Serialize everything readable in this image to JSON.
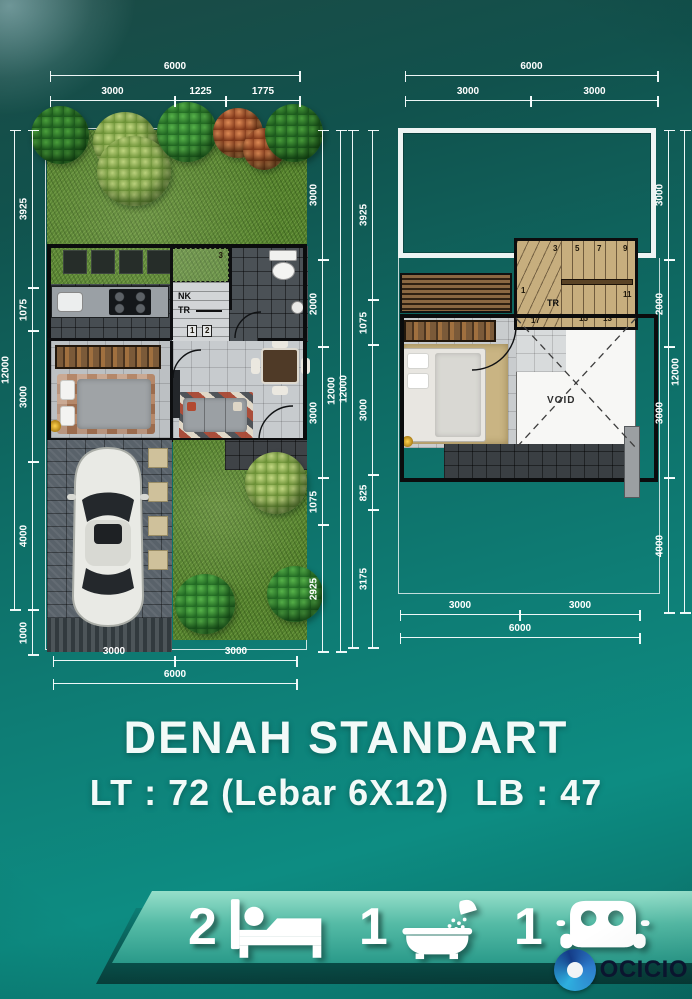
{
  "title": {
    "main": "DENAH STANDART",
    "spec_lt": "LT : 72 (Lebar 6X12)",
    "spec_lb": "LB : 47"
  },
  "plans": {
    "ground": {
      "dims": {
        "top_total": "6000",
        "top_segs": [
          "3000",
          "1225",
          "1775"
        ],
        "left_total": "12000",
        "left_segs": [
          "3925",
          "1075",
          "3000",
          "4000",
          "1000"
        ],
        "right_total": "12000",
        "right_segs": [
          "3000",
          "2000",
          "3000",
          "1075",
          "2925"
        ],
        "bottom_total": "6000",
        "bottom_segs": [
          "3000",
          "3000"
        ]
      },
      "labels": {
        "nk": "NK",
        "tr": "TR",
        "steps": [
          "3",
          "1",
          "2"
        ]
      }
    },
    "upper": {
      "dims": {
        "top_total": "6000",
        "top_segs": [
          "3000",
          "3000"
        ],
        "left_total": "12000",
        "left_segs": [
          "3925",
          "1075",
          "3000",
          "825",
          "3175"
        ],
        "right_total": "12000",
        "right_segs": [
          "3000",
          "2000",
          "3000",
          "4000"
        ],
        "bottom_total": "6000",
        "bottom_segs": [
          "3000",
          "3000"
        ]
      },
      "labels": {
        "tr": "TR",
        "void": "VOID",
        "steps": [
          "1",
          "3",
          "5",
          "7",
          "9",
          "11",
          "13",
          "15",
          "17"
        ]
      }
    }
  },
  "features": {
    "bedrooms": "2",
    "bathrooms": "1",
    "carports": "1"
  },
  "logo": {
    "text": "OCICIO"
  },
  "colors": {
    "background_teal": "#0e7d75",
    "banner_green": "#55bba6",
    "dimension_white": "#ffffff",
    "logo_blue": "#143c88",
    "grass_green": "#527f2b"
  }
}
